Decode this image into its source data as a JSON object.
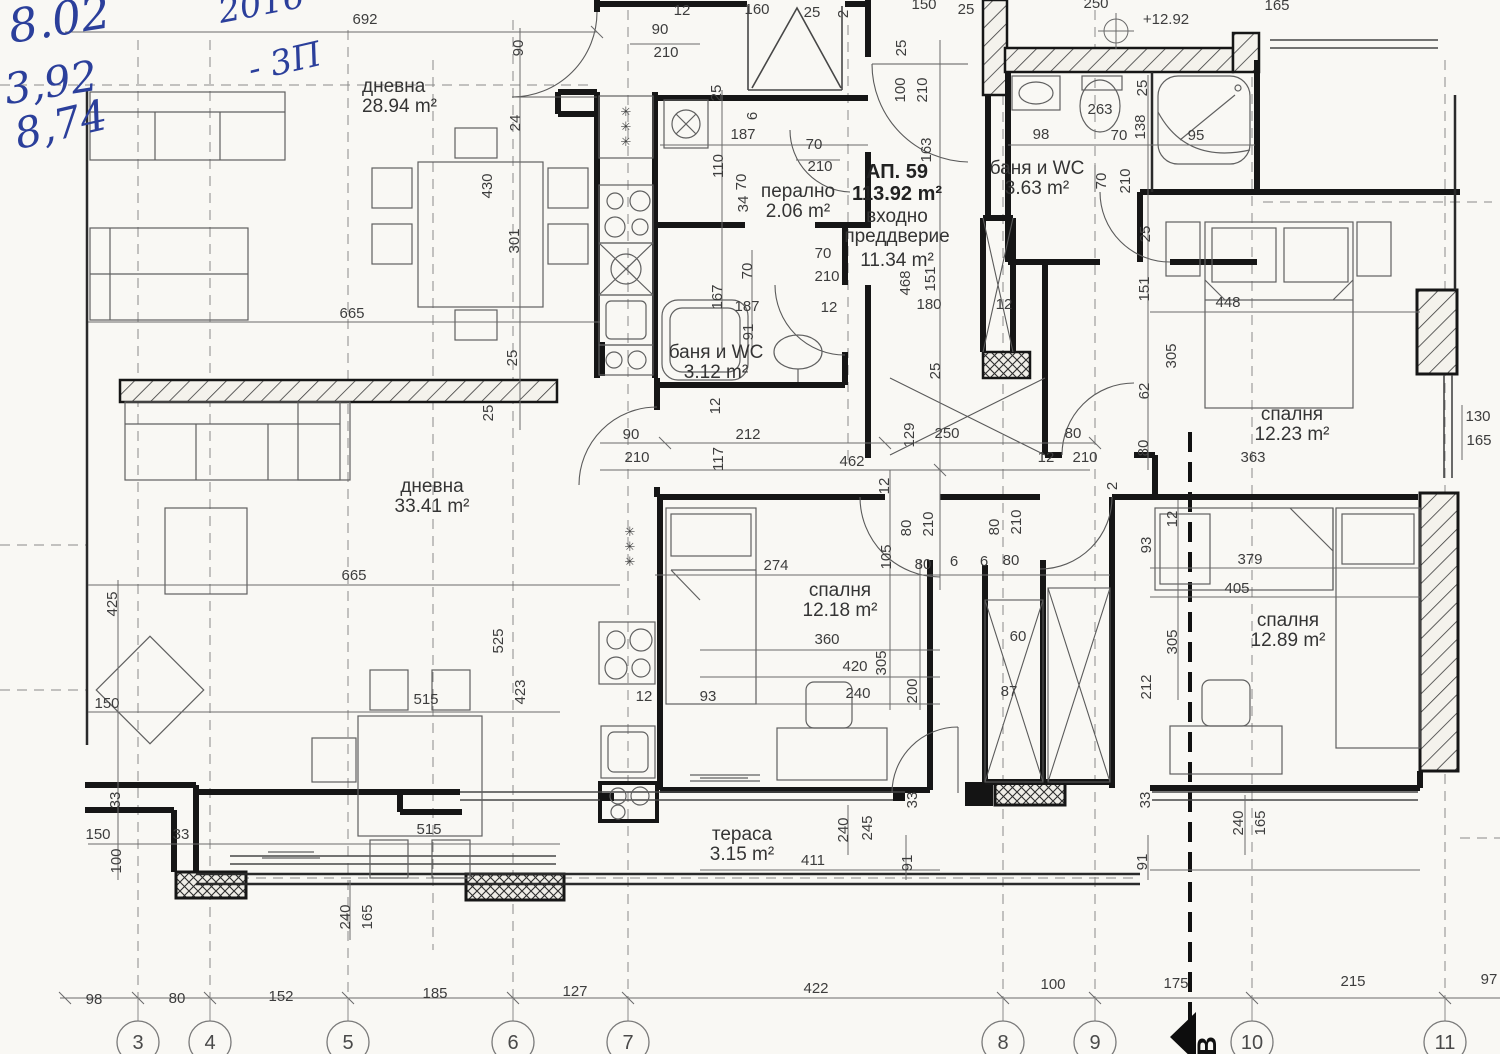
{
  "handwriting": {
    "date": "8.02",
    "year": "2016",
    "note_value": "3,92",
    "note_suffix": "- 3П",
    "note2": "8,74",
    "ink_color": "#2b3f9b"
  },
  "apartment": {
    "label": "АП. 59",
    "area": "113.92 m²",
    "x": 897,
    "y": 178
  },
  "rooms": [
    {
      "n": "дневна",
      "a": "28.94 m²",
      "x": 362,
      "y": 92,
      "al": "start"
    },
    {
      "n": "перално",
      "a": "2.06 m²",
      "x": 798,
      "y": 197
    },
    {
      "n": "входно",
      "a": "преддверие",
      "x": 897,
      "y": 222
    },
    {
      "n": "11.34 m²",
      "a": "",
      "x": 897,
      "y": 266
    },
    {
      "n": "баня и WC",
      "a": "3.12 m²",
      "x": 716,
      "y": 358
    },
    {
      "n": "баня и WC",
      "a": "3.63 m²",
      "x": 1037,
      "y": 174
    },
    {
      "n": "спалня",
      "a": "12.23 m²",
      "x": 1292,
      "y": 420
    },
    {
      "n": "дневна",
      "a": "33.41 m²",
      "x": 432,
      "y": 492
    },
    {
      "n": "спалня",
      "a": "12.18 m²",
      "x": 840,
      "y": 596
    },
    {
      "n": "спалня",
      "a": "12.89 m²",
      "x": 1288,
      "y": 626
    },
    {
      "n": "тераса",
      "a": "3.15 m²",
      "x": 742,
      "y": 840
    }
  ],
  "level_mark": "+12.92",
  "dimensions": [
    {
      "t": "692",
      "x": 365,
      "y": 24
    },
    {
      "t": "12",
      "x": 682,
      "y": 15
    },
    {
      "t": "90",
      "x": 660,
      "y": 34
    },
    {
      "t": "210",
      "x": 666,
      "y": 57
    },
    {
      "t": "160",
      "x": 757,
      "y": 14
    },
    {
      "t": "25",
      "x": 812,
      "y": 17
    },
    {
      "t": "2",
      "x": 848,
      "y": 14,
      "v": 1
    },
    {
      "t": "150",
      "x": 924,
      "y": 9
    },
    {
      "t": "25",
      "x": 966,
      "y": 14
    },
    {
      "t": "250",
      "x": 1096,
      "y": 8
    },
    {
      "t": "+12.92",
      "x": 1166,
      "y": 24
    },
    {
      "t": "165",
      "x": 1277,
      "y": 10
    },
    {
      "t": "25",
      "x": 906,
      "y": 48,
      "v": 1
    },
    {
      "t": "100",
      "x": 905,
      "y": 90,
      "v": 1
    },
    {
      "t": "210",
      "x": 927,
      "y": 90,
      "v": 1
    },
    {
      "t": "163",
      "x": 931,
      "y": 150,
      "v": 1
    },
    {
      "t": "98",
      "x": 1041,
      "y": 139
    },
    {
      "t": "263",
      "x": 1100,
      "y": 114
    },
    {
      "t": "70",
      "x": 1119,
      "y": 140
    },
    {
      "t": "138",
      "x": 1145,
      "y": 127,
      "v": 1
    },
    {
      "t": "95",
      "x": 1196,
      "y": 140
    },
    {
      "t": "25",
      "x": 1147,
      "y": 88,
      "v": 1
    },
    {
      "t": "70",
      "x": 1106,
      "y": 181,
      "v": 1
    },
    {
      "t": "210",
      "x": 1130,
      "y": 181,
      "v": 1
    },
    {
      "t": "90",
      "x": 523,
      "y": 48,
      "v": 1
    },
    {
      "t": "24",
      "x": 520,
      "y": 123,
      "v": 1
    },
    {
      "t": "430",
      "x": 492,
      "y": 186,
      "v": 1
    },
    {
      "t": "301",
      "x": 519,
      "y": 241,
      "v": 1
    },
    {
      "t": "25",
      "x": 517,
      "y": 358,
      "v": 1
    },
    {
      "t": "25",
      "x": 493,
      "y": 413,
      "v": 1
    },
    {
      "t": "665",
      "x": 352,
      "y": 318
    },
    {
      "t": "665",
      "x": 354,
      "y": 580
    },
    {
      "t": "425",
      "x": 117,
      "y": 604,
      "v": 1
    },
    {
      "t": "525",
      "x": 503,
      "y": 641,
      "v": 1
    },
    {
      "t": "423",
      "x": 525,
      "y": 692,
      "v": 1
    },
    {
      "t": "150",
      "x": 107,
      "y": 708
    },
    {
      "t": "515",
      "x": 426,
      "y": 704
    },
    {
      "t": "515",
      "x": 429,
      "y": 834
    },
    {
      "t": "33",
      "x": 120,
      "y": 800,
      "v": 1
    },
    {
      "t": "150",
      "x": 98,
      "y": 839
    },
    {
      "t": "33",
      "x": 181,
      "y": 839
    },
    {
      "t": "100",
      "x": 121,
      "y": 861,
      "v": 1
    },
    {
      "t": "240",
      "x": 350,
      "y": 917,
      "v": 1
    },
    {
      "t": "165",
      "x": 372,
      "y": 917,
      "v": 1
    },
    {
      "t": "25",
      "x": 721,
      "y": 93,
      "v": 1
    },
    {
      "t": "6",
      "x": 757,
      "y": 116,
      "v": 1
    },
    {
      "t": "187",
      "x": 743,
      "y": 139
    },
    {
      "t": "110",
      "x": 723,
      "y": 166,
      "v": 1
    },
    {
      "t": "70",
      "x": 746,
      "y": 182,
      "v": 1
    },
    {
      "t": "34",
      "x": 748,
      "y": 204,
      "v": 1
    },
    {
      "t": "70",
      "x": 814,
      "y": 149
    },
    {
      "t": "210",
      "x": 820,
      "y": 171
    },
    {
      "t": "167",
      "x": 722,
      "y": 297,
      "v": 1
    },
    {
      "t": "187",
      "x": 747,
      "y": 311
    },
    {
      "t": "91",
      "x": 753,
      "y": 332,
      "v": 1
    },
    {
      "t": "12",
      "x": 829,
      "y": 312
    },
    {
      "t": "70",
      "x": 752,
      "y": 271,
      "v": 1
    },
    {
      "t": "70",
      "x": 823,
      "y": 258
    },
    {
      "t": "210",
      "x": 827,
      "y": 281
    },
    {
      "t": "180",
      "x": 929,
      "y": 309
    },
    {
      "t": "468",
      "x": 910,
      "y": 283,
      "v": 1
    },
    {
      "t": "151",
      "x": 935,
      "y": 279,
      "v": 1
    },
    {
      "t": "25",
      "x": 940,
      "y": 371,
      "v": 1
    },
    {
      "t": "12",
      "x": 1004,
      "y": 309
    },
    {
      "t": "90",
      "x": 631,
      "y": 439
    },
    {
      "t": "210",
      "x": 637,
      "y": 462
    },
    {
      "t": "212",
      "x": 748,
      "y": 439
    },
    {
      "t": "462",
      "x": 852,
      "y": 466
    },
    {
      "t": "117",
      "x": 723,
      "y": 459,
      "v": 1
    },
    {
      "t": "12",
      "x": 720,
      "y": 406,
      "v": 1
    },
    {
      "t": "129",
      "x": 914,
      "y": 435,
      "v": 1
    },
    {
      "t": "250",
      "x": 947,
      "y": 438
    },
    {
      "t": "80",
      "x": 1073,
      "y": 438
    },
    {
      "t": "12",
      "x": 1046,
      "y": 462
    },
    {
      "t": "210",
      "x": 1085,
      "y": 462
    },
    {
      "t": "12",
      "x": 889,
      "y": 486,
      "v": 1
    },
    {
      "t": "80",
      "x": 911,
      "y": 528,
      "v": 1
    },
    {
      "t": "210",
      "x": 933,
      "y": 524,
      "v": 1
    },
    {
      "t": "80",
      "x": 999,
      "y": 527,
      "v": 1
    },
    {
      "t": "210",
      "x": 1021,
      "y": 522,
      "v": 1
    },
    {
      "t": "105",
      "x": 891,
      "y": 557,
      "v": 1
    },
    {
      "t": "80",
      "x": 923,
      "y": 569
    },
    {
      "t": "6",
      "x": 954,
      "y": 566
    },
    {
      "t": "6",
      "x": 984,
      "y": 566
    },
    {
      "t": "80",
      "x": 1011,
      "y": 565
    },
    {
      "t": "274",
      "x": 776,
      "y": 570
    },
    {
      "t": "448",
      "x": 1228,
      "y": 307
    },
    {
      "t": "305",
      "x": 1176,
      "y": 356,
      "v": 1
    },
    {
      "t": "151",
      "x": 1149,
      "y": 289,
      "v": 1
    },
    {
      "t": "25",
      "x": 1150,
      "y": 234,
      "v": 1
    },
    {
      "t": "62",
      "x": 1149,
      "y": 391,
      "v": 1
    },
    {
      "t": "80",
      "x": 1148,
      "y": 448,
      "v": 1
    },
    {
      "t": "130",
      "x": 1478,
      "y": 421
    },
    {
      "t": "165",
      "x": 1479,
      "y": 445
    },
    {
      "t": "363",
      "x": 1253,
      "y": 462
    },
    {
      "t": "2",
      "x": 1117,
      "y": 486,
      "v": 1
    },
    {
      "t": "12",
      "x": 1177,
      "y": 519,
      "v": 1
    },
    {
      "t": "93",
      "x": 1151,
      "y": 545,
      "v": 1
    },
    {
      "t": "379",
      "x": 1250,
      "y": 564
    },
    {
      "t": "405",
      "x": 1237,
      "y": 593
    },
    {
      "t": "305",
      "x": 1177,
      "y": 642,
      "v": 1
    },
    {
      "t": "212",
      "x": 1151,
      "y": 687,
      "v": 1
    },
    {
      "t": "360",
      "x": 827,
      "y": 644
    },
    {
      "t": "420",
      "x": 855,
      "y": 671
    },
    {
      "t": "305",
      "x": 886,
      "y": 663,
      "v": 1
    },
    {
      "t": "200",
      "x": 917,
      "y": 691,
      "v": 1
    },
    {
      "t": "240",
      "x": 858,
      "y": 698
    },
    {
      "t": "93",
      "x": 708,
      "y": 701
    },
    {
      "t": "12",
      "x": 644,
      "y": 701
    },
    {
      "t": "60",
      "x": 1018,
      "y": 641
    },
    {
      "t": "87",
      "x": 1009,
      "y": 696
    },
    {
      "t": "33",
      "x": 917,
      "y": 800,
      "v": 1
    },
    {
      "t": "91",
      "x": 912,
      "y": 863,
      "v": 1
    },
    {
      "t": "411",
      "x": 813,
      "y": 865
    },
    {
      "t": "240",
      "x": 848,
      "y": 830,
      "v": 1
    },
    {
      "t": "245",
      "x": 872,
      "y": 828,
      "v": 1
    },
    {
      "t": "33",
      "x": 1150,
      "y": 800,
      "v": 1
    },
    {
      "t": "91",
      "x": 1147,
      "y": 862,
      "v": 1
    },
    {
      "t": "240",
      "x": 1243,
      "y": 823,
      "v": 1
    },
    {
      "t": "165",
      "x": 1265,
      "y": 823,
      "v": 1
    },
    {
      "t": "98",
      "x": 94,
      "y": 1004
    },
    {
      "t": "80",
      "x": 177,
      "y": 1003
    },
    {
      "t": "152",
      "x": 281,
      "y": 1001
    },
    {
      "t": "185",
      "x": 435,
      "y": 998
    },
    {
      "t": "127",
      "x": 575,
      "y": 996
    },
    {
      "t": "422",
      "x": 816,
      "y": 993
    },
    {
      "t": "100",
      "x": 1053,
      "y": 989
    },
    {
      "t": "175",
      "x": 1176,
      "y": 988
    },
    {
      "t": "215",
      "x": 1353,
      "y": 986
    },
    {
      "t": "97",
      "x": 1489,
      "y": 984
    }
  ],
  "symbols": [
    {
      "t": "✳",
      "x": 626,
      "y": 116
    },
    {
      "t": "✳",
      "x": 626,
      "y": 131
    },
    {
      "t": "✳",
      "x": 626,
      "y": 146
    },
    {
      "t": "✳",
      "x": 630,
      "y": 536
    },
    {
      "t": "✳",
      "x": 630,
      "y": 551
    },
    {
      "t": "✳",
      "x": 630,
      "y": 566
    }
  ],
  "axes": {
    "circles": [
      {
        "label": "3",
        "x": 138
      },
      {
        "label": "4",
        "x": 210
      },
      {
        "label": "5",
        "x": 348
      },
      {
        "label": "6",
        "x": 513
      },
      {
        "label": "7",
        "x": 628
      },
      {
        "label": "8",
        "x": 1003
      },
      {
        "label": "9",
        "x": 1095
      },
      {
        "label": "10",
        "x": 1252
      },
      {
        "label": "11",
        "x": 1445
      }
    ],
    "circle_y": 1042,
    "section_marker": "В"
  },
  "colors": {
    "paper": "#f9f8f4",
    "wall": "#161616",
    "ink": "#2b3f9b"
  }
}
